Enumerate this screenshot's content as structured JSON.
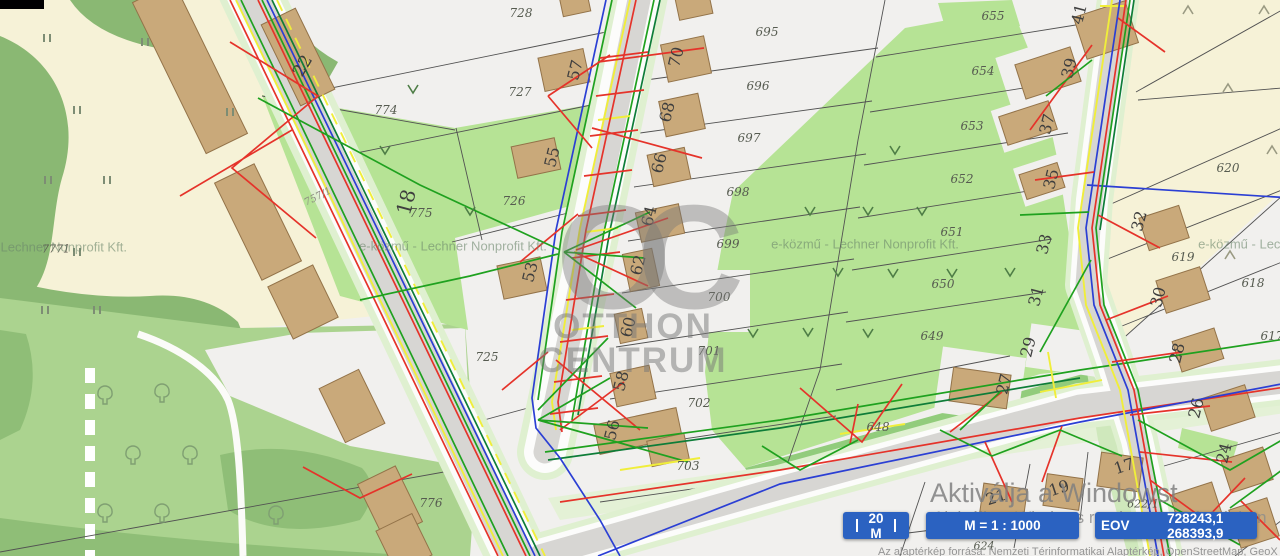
{
  "map": {
    "utility_watermark": "e-közmű - Lechner Nonprofit Kft.",
    "parcel_labels": [
      {
        "t": "728",
        "x": 521,
        "y": 13
      },
      {
        "t": "727",
        "x": 520,
        "y": 92
      },
      {
        "t": "774",
        "x": 386,
        "y": 110
      },
      {
        "t": "775",
        "x": 421,
        "y": 213
      },
      {
        "t": "726",
        "x": 514,
        "y": 201
      },
      {
        "t": "725",
        "x": 487,
        "y": 357
      },
      {
        "t": "776",
        "x": 431,
        "y": 503
      },
      {
        "t": "757/1",
        "x": 318,
        "y": 197,
        "r": -27,
        "s": 10,
        "c": "#8b8b80"
      },
      {
        "t": "7771",
        "x": 56,
        "y": 249,
        "s": 11,
        "c": "#56534b"
      },
      {
        "t": "695",
        "x": 767,
        "y": 32
      },
      {
        "t": "696",
        "x": 758,
        "y": 86
      },
      {
        "t": "697",
        "x": 749,
        "y": 138
      },
      {
        "t": "698",
        "x": 738,
        "y": 192
      },
      {
        "t": "699",
        "x": 728,
        "y": 244
      },
      {
        "t": "700",
        "x": 719,
        "y": 297
      },
      {
        "t": "701",
        "x": 709,
        "y": 351
      },
      {
        "t": "702",
        "x": 699,
        "y": 403
      },
      {
        "t": "703",
        "x": 688,
        "y": 466
      },
      {
        "t": "655",
        "x": 993,
        "y": 16
      },
      {
        "t": "654",
        "x": 983,
        "y": 71
      },
      {
        "t": "653",
        "x": 972,
        "y": 126
      },
      {
        "t": "652",
        "x": 962,
        "y": 179
      },
      {
        "t": "651",
        "x": 952,
        "y": 232
      },
      {
        "t": "650",
        "x": 943,
        "y": 284
      },
      {
        "t": "649",
        "x": 932,
        "y": 336
      },
      {
        "t": "648",
        "x": 878,
        "y": 427
      },
      {
        "t": "620",
        "x": 1228,
        "y": 168
      },
      {
        "t": "619",
        "x": 1183,
        "y": 257
      },
      {
        "t": "618",
        "x": 1253,
        "y": 283
      },
      {
        "t": "617",
        "x": 1272,
        "y": 336
      },
      {
        "t": "622/1",
        "x": 1143,
        "y": 504,
        "s": 11
      },
      {
        "t": "624",
        "x": 984,
        "y": 546,
        "s": 11
      }
    ],
    "house_numbers": [
      {
        "t": "22",
        "x": 303,
        "y": 66,
        "r": -60,
        "s": 17
      },
      {
        "t": "18",
        "x": 406,
        "y": 202,
        "r": -75,
        "s": 20
      },
      {
        "t": "57",
        "x": 575,
        "y": 70
      },
      {
        "t": "55",
        "x": 552,
        "y": 157
      },
      {
        "t": "53",
        "x": 530,
        "y": 272
      },
      {
        "t": "70",
        "x": 676,
        "y": 57
      },
      {
        "t": "68",
        "x": 667,
        "y": 112
      },
      {
        "t": "66",
        "x": 659,
        "y": 163
      },
      {
        "t": "64",
        "x": 649,
        "y": 216
      },
      {
        "t": "62",
        "x": 638,
        "y": 265
      },
      {
        "t": "60",
        "x": 628,
        "y": 327
      },
      {
        "t": "58",
        "x": 621,
        "y": 381
      },
      {
        "t": "56",
        "x": 612,
        "y": 430
      },
      {
        "t": "41",
        "x": 1079,
        "y": 14
      },
      {
        "t": "39",
        "x": 1069,
        "y": 68
      },
      {
        "t": "37",
        "x": 1047,
        "y": 124
      },
      {
        "t": "35",
        "x": 1051,
        "y": 179
      },
      {
        "t": "33",
        "x": 1044,
        "y": 244
      },
      {
        "t": "31",
        "x": 1036,
        "y": 296
      },
      {
        "t": "29",
        "x": 1028,
        "y": 347
      },
      {
        "t": "27",
        "x": 1004,
        "y": 384
      },
      {
        "t": "32",
        "x": 1139,
        "y": 221
      },
      {
        "t": "30",
        "x": 1158,
        "y": 297
      },
      {
        "t": "28",
        "x": 1177,
        "y": 353
      },
      {
        "t": "26",
        "x": 1196,
        "y": 408
      },
      {
        "t": "24",
        "x": 1224,
        "y": 453
      },
      {
        "t": "21",
        "x": 996,
        "y": 497,
        "r": -18
      },
      {
        "t": "19",
        "x": 1059,
        "y": 488,
        "r": -18
      },
      {
        "t": "17",
        "x": 1124,
        "y": 466,
        "r": -18
      }
    ]
  },
  "brand_watermark": {
    "monogram": "OC",
    "line1": "OTTHON",
    "line2": "CENTRUM"
  },
  "windows_watermark": {
    "line1": "Aktiválja a Windowst",
    "line2": "Aktiválja a Windows rendszert a Gépházban"
  },
  "statusbar": {
    "scale_bar_label": "20 M",
    "scale_ratio": "M = 1 : 1000",
    "eov_label": "EOV",
    "eov_coords": "728243,1  268393,9"
  },
  "attribution": "Az alaptérkép forrása: Nemzeti Térinformatikai Alaptérkép, OpenStreetMap, GeoX ArcMagyarország",
  "colors": {
    "button": "#2b62c1",
    "utility_red": "#e5332a",
    "utility_green": "#1fa11f",
    "utility_blue": "#2b3fd4",
    "utility_yellow": "#f0ee3a",
    "grass_green": "#b6e395",
    "building": "#c9a97a"
  }
}
